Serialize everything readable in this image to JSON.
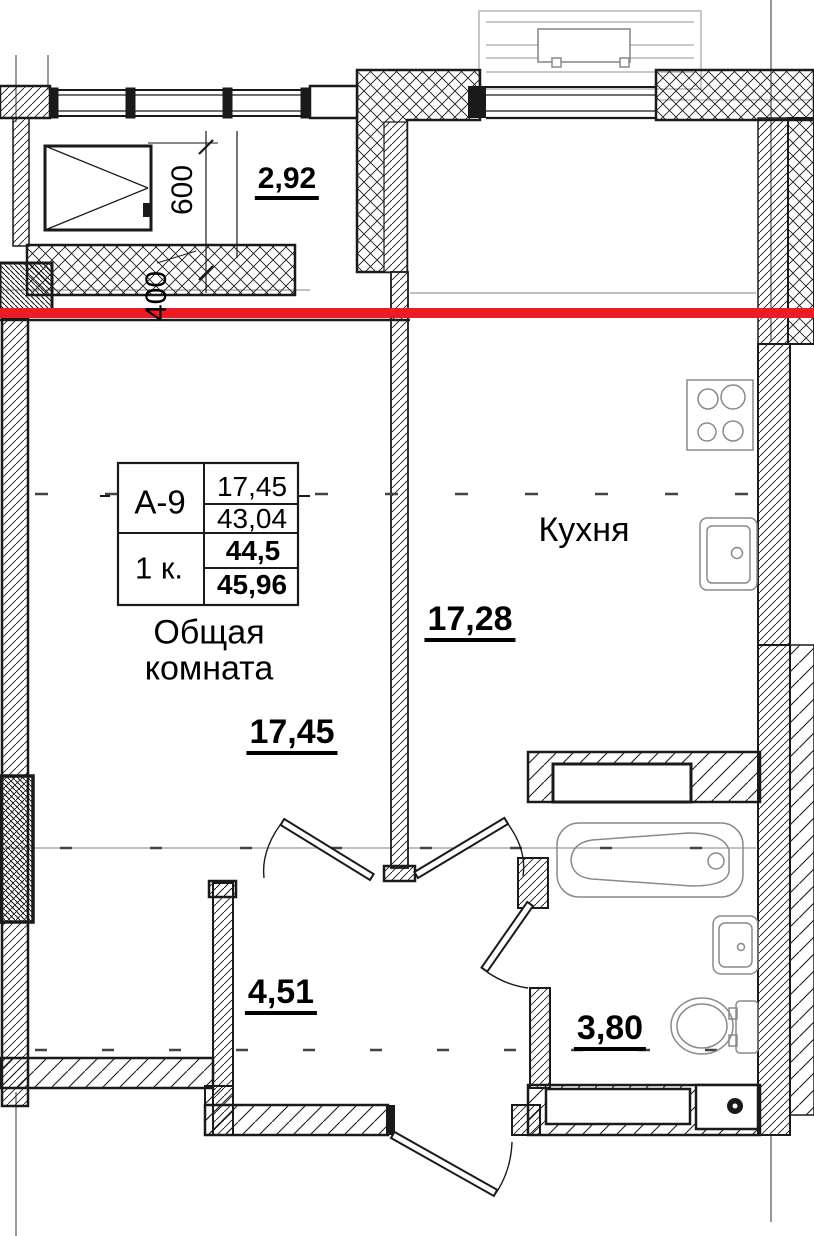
{
  "plan": {
    "table": {
      "code": "А-9",
      "rooms_count": "1 к.",
      "living_area": "17,45",
      "area_row2": "43,04",
      "area_row3": "44,5",
      "total_area": "45,96"
    },
    "rooms": {
      "living": {
        "name": "Общая комната",
        "area": "17,45"
      },
      "kitchen": {
        "name": "Кухня",
        "area": "17,28"
      },
      "hallway": {
        "area": "4,51"
      },
      "bathroom": {
        "area": "3,80"
      },
      "balcony": {
        "area": "2,92"
      }
    },
    "dimensions": {
      "window_width": "600",
      "ledge_offset": "400"
    },
    "colors": {
      "section_line": "#ed1c24",
      "walls": "#1a1a1a",
      "fixtures": "#8a8a8a",
      "upper_floor_outline": "#b5b5b5"
    },
    "icons": [
      "window-icon",
      "stove-icon",
      "kitchen-sink-icon",
      "bathtub-icon",
      "washbasin-icon",
      "toilet-icon",
      "door-leaf-icon"
    ]
  }
}
